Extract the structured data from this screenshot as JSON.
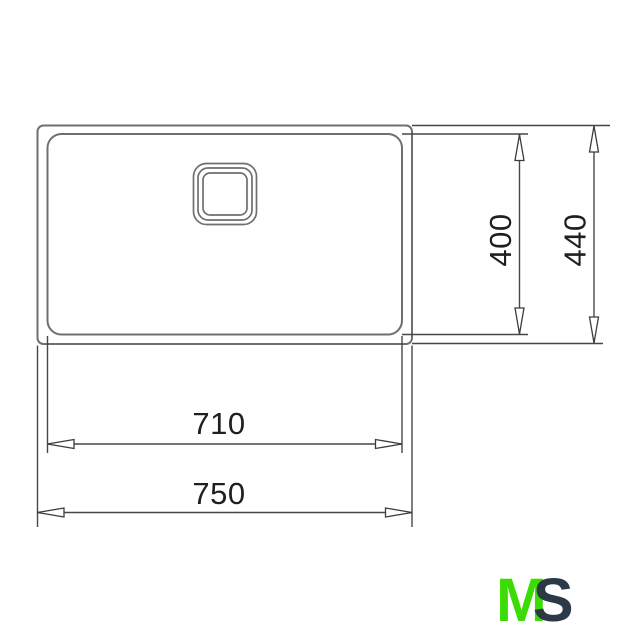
{
  "drawing": {
    "type": "technical-dimension-drawing",
    "subject": "sink-top-view",
    "dims": {
      "bowl_width": {
        "label": "710",
        "value": 710,
        "orientation": "horizontal"
      },
      "overall_width": {
        "label": "750",
        "value": 750,
        "orientation": "horizontal"
      },
      "bowl_depth": {
        "label": "400",
        "value": 400,
        "orientation": "vertical"
      },
      "overall_depth": {
        "label": "440",
        "value": 440,
        "orientation": "vertical"
      }
    },
    "colors": {
      "outline": "#6f6f6f",
      "dimension": "#474747",
      "text": "#1f1f1f",
      "background": "#ffffff"
    }
  },
  "logo": {
    "part1": "M",
    "part2": "S",
    "part1_color": "#3bdc04",
    "part2_color": "#2c3a48"
  }
}
